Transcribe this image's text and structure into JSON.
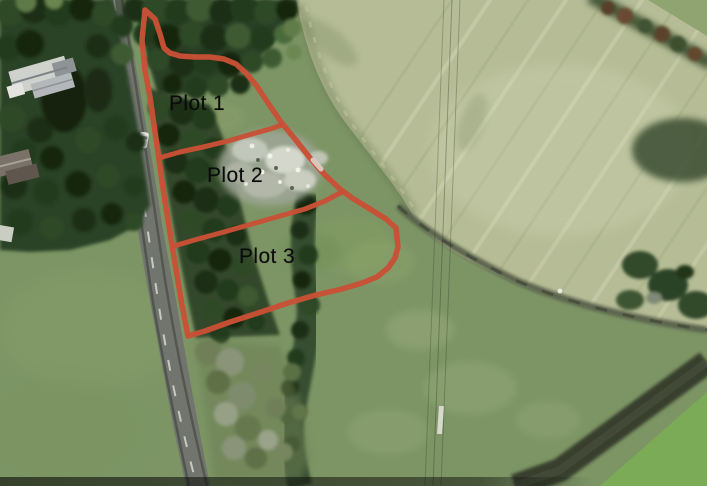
{
  "scene": {
    "kind": "aerial-drone-photo-with-plot-overlay",
    "boundary_color": "#c84f36",
    "label_color": "#0b0b0b"
  },
  "plots": [
    {
      "label": "Plot 1"
    },
    {
      "label": "Plot 2"
    },
    {
      "label": "Plot 3"
    }
  ]
}
